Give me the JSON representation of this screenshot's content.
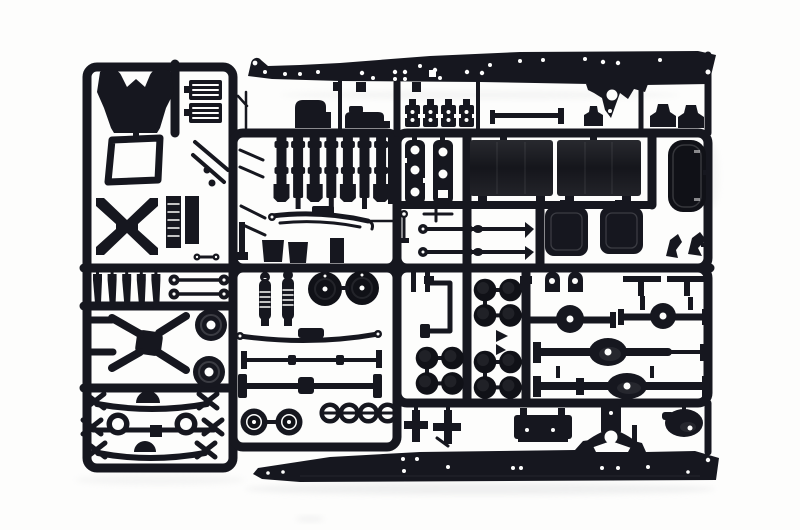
{
  "meta": {
    "title": "Photograph of a black plastic model-kit sprue (truck parts tree)",
    "image_width": 800,
    "image_height": 530,
    "visible_text": ""
  },
  "scene": {
    "subject": "injection-molded sprue of black plastic parts for a truck model kit",
    "background_description": "plain white seamless studio background",
    "material": "glossy black styrene plastic"
  },
  "colors": {
    "background": "#fdfdfc",
    "plastic": "#16171f",
    "plastic-deep": "#101117",
    "shadow": "#e4e5e6"
  },
  "parts": {
    "upper_chassis_rail": {
      "label": "upper chassis side rail",
      "count": 1
    },
    "lower_chassis_rail": {
      "label": "lower chassis side rail",
      "count": 1
    },
    "cab_back_panel": {
      "label": "cab rear panel",
      "count": 1
    },
    "cab_window_frame": {
      "label": "cab window frame",
      "count": 1
    },
    "h_brace": {
      "label": "H-shaped chassis brace",
      "count": 1
    },
    "step_grilles": {
      "label": "step grilles",
      "count": 2
    },
    "bracket_squares": {
      "label": "spring-hanger brackets",
      "count": 4
    },
    "crossmember_bars": {
      "label": "chassis crossmember bars",
      "count": 7
    },
    "ladder_frames": {
      "label": "drilled frame brackets",
      "count": 2
    },
    "fuel_tanks": {
      "label": "fuel tanks",
      "count": 2
    },
    "air_tank": {
      "label": "rounded air tank",
      "count": 1
    },
    "battery_boxes": {
      "label": "battery boxes",
      "count": 2
    },
    "tie_rods": {
      "label": "steering tie rods",
      "count": 2
    },
    "leaf_springs": {
      "label": "leaf springs",
      "count": 4
    },
    "shock_absorbers": {
      "label": "coil shock absorbers",
      "count": 2
    },
    "exhaust_pins": {
      "label": "exhaust stack pins",
      "count": 5
    },
    "pulleys": {
      "label": "pulley discs",
      "count": 2
    },
    "spare_tires": {
      "label": "solid tire discs",
      "count": 2
    },
    "wheels": {
      "label": "wheel hubs",
      "count": 2
    },
    "hub_rings": {
      "label": "hub rings",
      "count": 4
    },
    "wheel_hub_discs": {
      "label": "brake-drum caps",
      "count": 12
    },
    "axle_housings": {
      "label": "drive axle housings",
      "count": 4
    },
    "front_axle_assemblies": {
      "label": "front axle and spring assemblies",
      "count": 3
    },
    "mudflaps": {
      "label": "mud flaps",
      "count": 2
    },
    "tow_shackles": {
      "label": "tow shackles",
      "count": 2
    }
  }
}
